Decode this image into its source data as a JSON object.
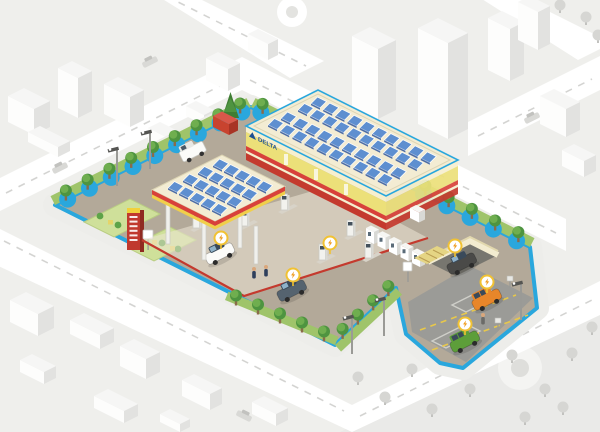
{
  "scene": {
    "description": "isometric-smart-gas-station-site-in-gray-city",
    "brand": {
      "logo_text": "DELTA"
    },
    "colors": {
      "bg": "#efefec",
      "road": "#ffffff",
      "dash": "#d4d4d2",
      "city_face": "#fdfdfc",
      "city_side": "#e2e2e0",
      "city_top": "#f6f6f5",
      "city_tree": "#d6d6d3",
      "site_border": "#2aa7dd",
      "sidewalk": "#ededea",
      "ground": "#b3a999",
      "parking_pad": "#9b9b97",
      "hedge_strip": "#9fc46a",
      "tree_dark": "#4e9440",
      "tree_light": "#6fae4f",
      "scallop_blue": "#2aa7dd",
      "solar_blue": "#5e8fd0",
      "solar_dark": "#31589e",
      "roof_cream": "#f3ecd3",
      "wall_cream": "#f6efcf",
      "wall_yellow": "#ece079",
      "stripe_red": "#d8413a",
      "base_red": "#c43a2e",
      "canopy_yellow": "#f0cf4a",
      "totem_red": "#c0392e",
      "totem_yellow": "#f2d13c",
      "container_red": "#c8432f",
      "van_orange": "#e8862a",
      "van_green": "#5d9e3a",
      "car_dark": "#55636f",
      "car_white": "#fbfbf9",
      "badge_ring": "#f1c233",
      "badge_bolt": "#ef9d1f",
      "logo_blue": "#1c4f92",
      "pad_lines": "#e8c84a"
    },
    "station": {
      "building_solar": {
        "bands": 2,
        "rows_per_band": 2,
        "cols": 10
      },
      "canopy_solar": {
        "rows": 4,
        "cols": 5
      },
      "fuel_dispensers": 6,
      "attendants": 2,
      "forecourt_vehicles": [
        {
          "type": "car",
          "color": "white"
        },
        {
          "type": "car",
          "color": "dark-blue"
        },
        {
          "type": "van",
          "color": "white"
        }
      ],
      "car_wash_vehicles": 1,
      "ev_charger_cabinets": 5,
      "parking": {
        "stalls": 2,
        "vehicles": [
          {
            "type": "van",
            "color": "orange"
          },
          {
            "type": "van",
            "color": "green"
          }
        ],
        "pedestrians": 1
      },
      "energy_badges": 6,
      "street_lamps": 5,
      "perimeter_trees": {
        "top_left": 9,
        "top_right": 12,
        "bottom_right": 4,
        "bottom_left": 5
      }
    },
    "city": {
      "blocks": 20,
      "gray_trees": 16,
      "cars": 4,
      "roundabout": 1,
      "park_plaza": 1
    }
  }
}
